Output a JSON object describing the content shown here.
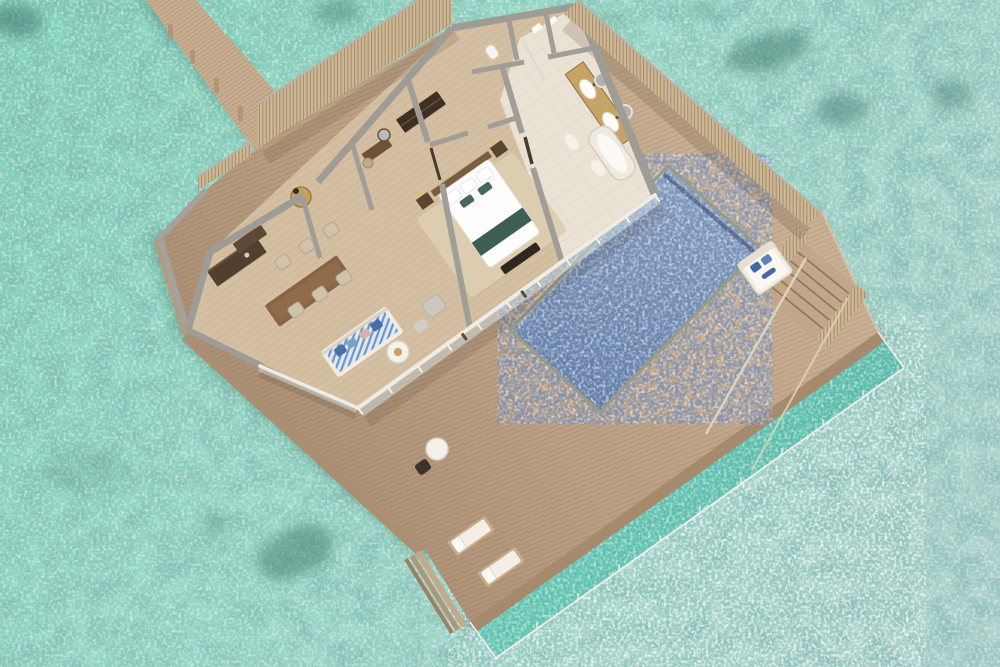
{
  "scene": {
    "title": "overwater-villa-3d-floor-plan",
    "description": "Aerial 3D cutaway floor-plan render of an overwater pool villa on a turquoise lagoon, with access jetty, slatted privacy fences, wraparound sun deck, private pool, overwater net lounge and sea-access stairs",
    "visible_text": ""
  },
  "colors": {
    "sea_shallow": "#82d1b9",
    "sea_mid": "#97d6c6",
    "sea_far": "#adcfca",
    "coral_patch": "#3f7a6e",
    "jetty_wood": "#c8ad8f",
    "deck_wood": "#c3a78a",
    "deck_edge": "#a68a6e",
    "fence_slat": "#cdb795",
    "wall_top": "#9f9c96",
    "floor_wood": "#d4bfa2",
    "floor_marble": "#e9e2d5",
    "pool_light": "#8ea6c6",
    "pool_deep": "#5a76a2",
    "net_teal": "#5cbfad",
    "glass": "#cfdce0",
    "gold": "#c59f63",
    "vanity_gold": "#c6a468",
    "sofa_base": "#dfe8f2",
    "sofa_stripe": "#6f96c2",
    "bed_white": "#fdfdfb",
    "bed_runner": "#3c5e53",
    "dark_furniture": "#4a3a2c",
    "lounger_pad": "#f3efe6",
    "daybed_cushion": "#3f66a6",
    "tub_white": "#fbfaf6"
  },
  "structures": {
    "jetty": {
      "name": "access-jetty",
      "material": "wood planks",
      "pilings": 4
    },
    "entrance_fence": {
      "name": "slatted-privacy-fence"
    },
    "deck": {
      "name": "wraparound-sun-deck",
      "material": "wood planks",
      "corner_steps": 3
    },
    "pool": {
      "name": "private-pool"
    },
    "net_lounge": {
      "name": "overwater-net-lounge",
      "railing": true
    },
    "sea_stairs": {
      "name": "lagoon-access-stairs",
      "handrails": 2
    }
  },
  "villa": {
    "rooms": [
      {
        "name": "open-plan-living-dining-kitchen",
        "furniture": [
          "kitchen-counter",
          "kitchen-island",
          "dining-table",
          "dining-chairs-x6",
          "striped-sofa",
          "coffee-table",
          "armchair",
          "ottoman"
        ]
      },
      {
        "name": "entry-foyer",
        "furniture": [
          "gold-console-table",
          "table-lamp"
        ]
      },
      {
        "name": "dressing-room",
        "furniture": [
          "wardrobe",
          "vanity-desk",
          "round-mirror",
          "stool"
        ]
      },
      {
        "name": "wc",
        "furniture": [
          "toilet"
        ]
      },
      {
        "name": "shower-room",
        "furniture": [
          "towel-stacks",
          "glass-screen"
        ]
      },
      {
        "name": "bedroom",
        "furniture": [
          "king-bed",
          "bed-runner",
          "pillows",
          "foot-bench",
          "nightstand-left",
          "nightstand-right",
          "area-rug",
          "sliding-glass-door"
        ]
      },
      {
        "name": "bathroom",
        "furniture": [
          "double-vanity",
          "twin-sinks",
          "round-mirrors-x2",
          "freestanding-bathtub",
          "bath-mats"
        ]
      }
    ]
  },
  "deck_furniture": [
    "daybed-with-blue-cushions",
    "sun-lounger-1",
    "sun-lounger-2",
    "round-side-table",
    "deck-chair"
  ]
}
